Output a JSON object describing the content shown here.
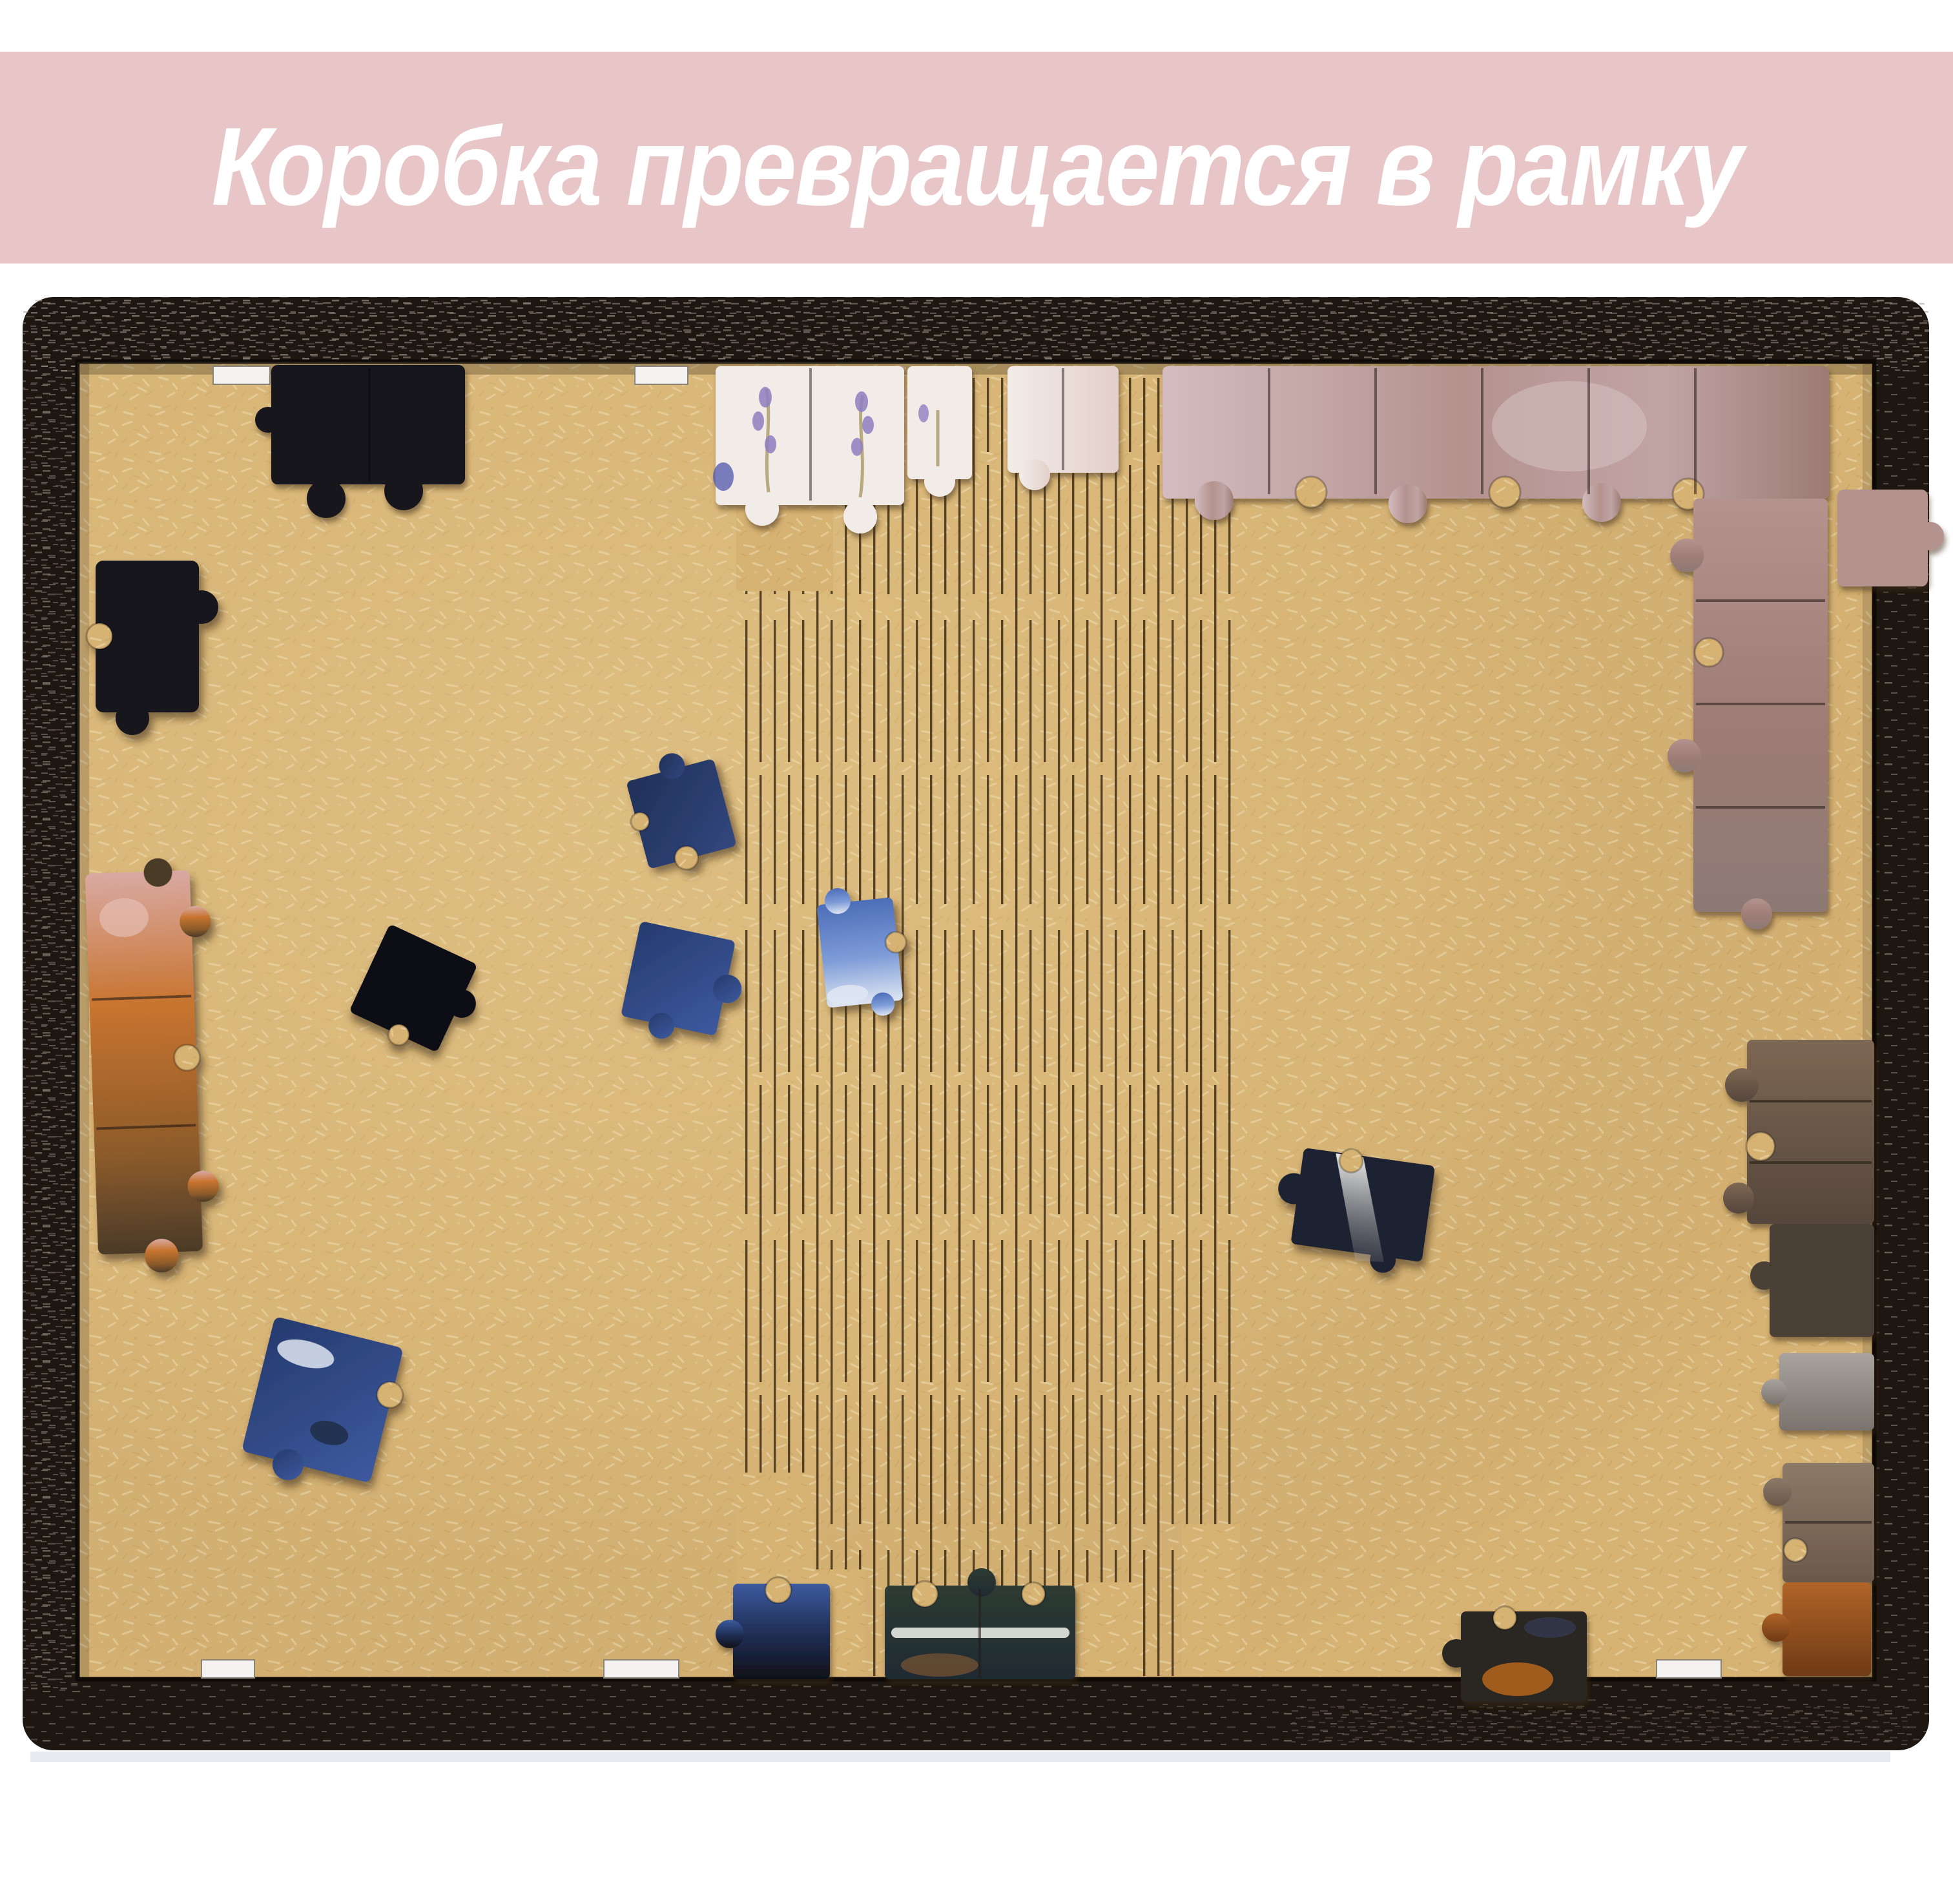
{
  "banner": {
    "text": "Коробка превращается в рамку",
    "bg": "#e8c5c7",
    "fg": "#ffffff"
  },
  "colors": {
    "page_bg": "#ffffff",
    "frame": "#1e1610",
    "frame_speck": "#9a9188",
    "frame_speck2": "#6f665e",
    "board": "#d6b273",
    "board_fiber": "#eddcae",
    "board_fiber2": "#c29a55",
    "board_glow": "#f0dca6",
    "hinge_line": "#3f2d13",
    "slot": "#f4f3f1",
    "seam": "#241b16",
    "black": "#17171d",
    "black2": "#101018",
    "navy": "#203058",
    "navy_light": "#32477e",
    "blue": "#3d5a9e",
    "blue_dark": "#263a6e",
    "sky": "#7e9cd8",
    "sky_dark": "#4d6db8",
    "cloud": "#dfe6f2",
    "white_piece": "#f2ece9",
    "white_pink": "#e3cfc9",
    "lavender": "#8f7fc0",
    "stem": "#b9a97f",
    "flower_blue": "#5a5fae",
    "pink_light": "#d3bcbf",
    "pink_mid": "#b4928e",
    "pink_dark": "#9c7b74",
    "autumn_pink": "#d9a9a2",
    "autumn_orange": "#c8742f",
    "autumn_dark": "#4a3a28",
    "brown_light": "#7d6753",
    "brown_dark": "#55463c",
    "umber": "#4c3f35",
    "grey_light": "#a8a39e",
    "grey_dark": "#7b736c",
    "taupe": "#8c7a68",
    "taupe_dark": "#6b584a",
    "orange": "#b06428",
    "orange_dark": "#6f3a16",
    "lake": "#2e3b33",
    "lake_dark": "#1f2a33",
    "streak": "#e8e8e6",
    "rust": "#b5651d",
    "reflection": "#e3e7ee",
    "shadow": "#3a2a10"
  }
}
